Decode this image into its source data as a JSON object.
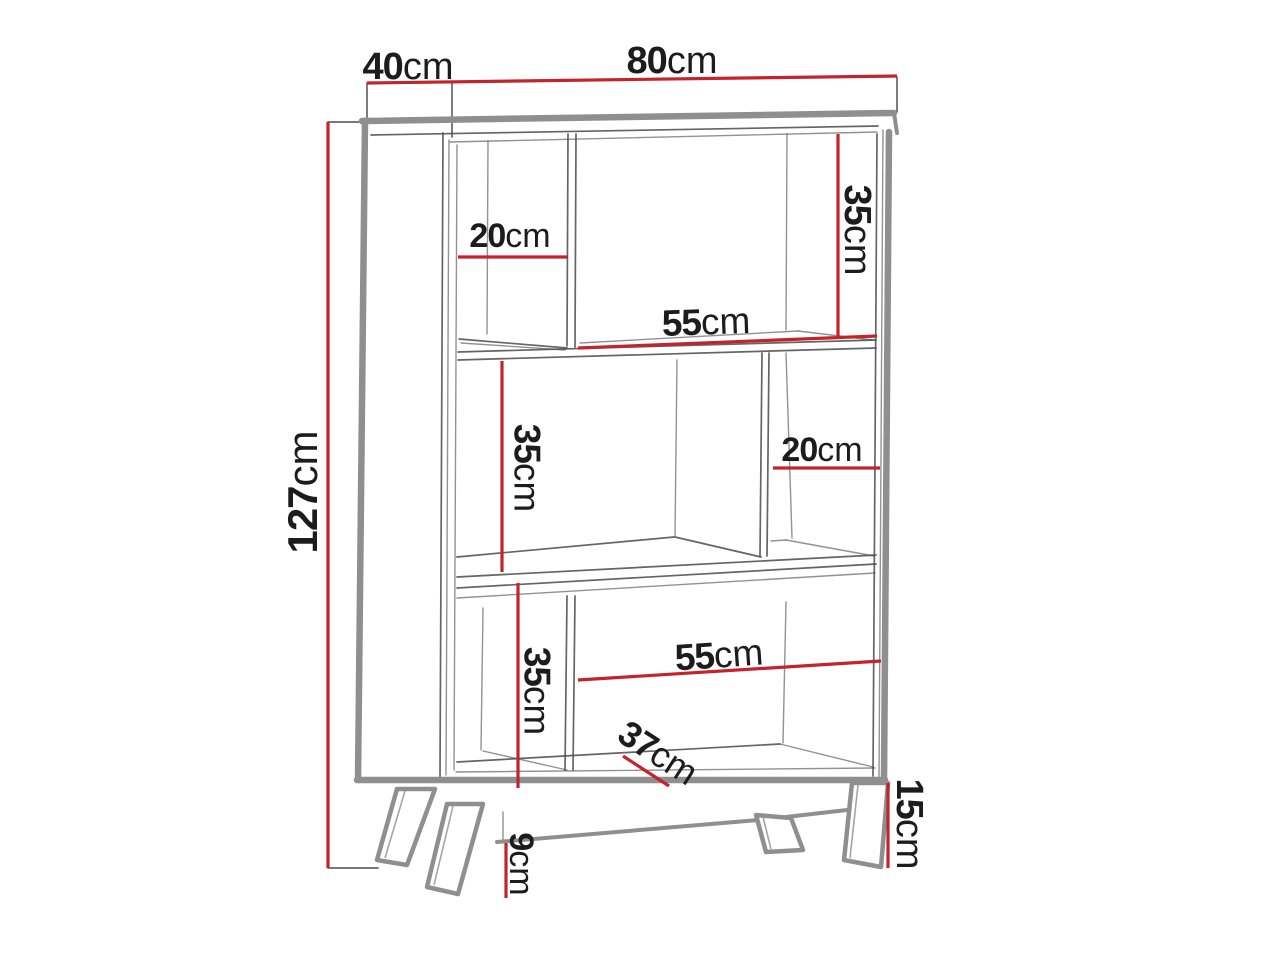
{
  "diagram": {
    "subject": "bookcase-dimension-drawing",
    "unit": "cm",
    "dims": {
      "depth": {
        "value": "40",
        "unit": "cm"
      },
      "width": {
        "value": "80",
        "unit": "cm"
      },
      "height": {
        "value": "127",
        "unit": "cm"
      },
      "top_right_height": {
        "value": "35",
        "unit": "cm"
      },
      "top_left_width": {
        "value": "20",
        "unit": "cm"
      },
      "top_shelf_span": {
        "value": "55",
        "unit": "cm"
      },
      "middle_left_height": {
        "value": "35",
        "unit": "cm"
      },
      "middle_right_width": {
        "value": "20",
        "unit": "cm"
      },
      "bottom_left_height": {
        "value": "35",
        "unit": "cm"
      },
      "bottom_shelf_span": {
        "value": "55",
        "unit": "cm"
      },
      "bottom_diagonal": {
        "value": "37",
        "unit": "cm"
      },
      "leg_height": {
        "value": "15",
        "unit": "cm"
      },
      "under_clearance": {
        "value": "9",
        "unit": "cm"
      }
    }
  },
  "colors": {
    "dimension_line": "#c3242c",
    "outline": "#8f8f8f",
    "sketch": "#4a4a4a",
    "text": "#1c1c1c",
    "background": "#ffffff"
  }
}
